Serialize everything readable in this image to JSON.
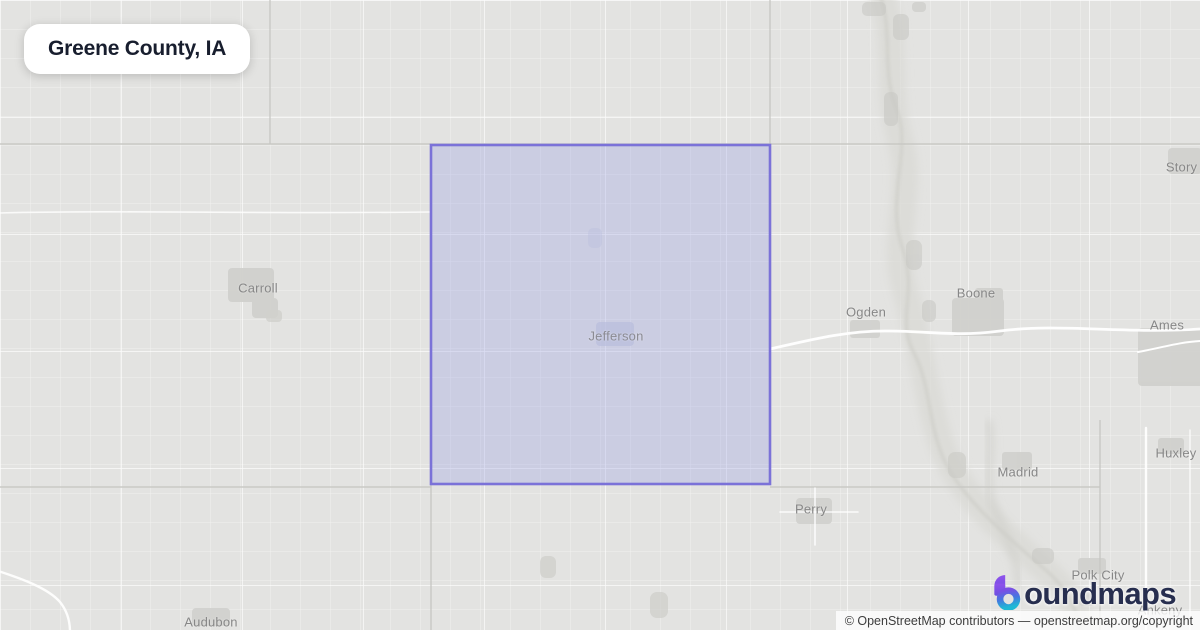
{
  "title_card": {
    "title": "Greene County, IA"
  },
  "map": {
    "county": {
      "name": "Greene",
      "fill_color": "#9ba1e4",
      "stroke_color": "#7b72d8"
    },
    "cities": [
      {
        "name": "Carroll"
      },
      {
        "name": "Jefferson"
      },
      {
        "name": "Ogden"
      },
      {
        "name": "Boone"
      },
      {
        "name": "Ames"
      },
      {
        "name": "Story City"
      },
      {
        "name": "Madrid"
      },
      {
        "name": "Huxley"
      },
      {
        "name": "Perry"
      },
      {
        "name": "Polk City"
      },
      {
        "name": "Ankeny"
      },
      {
        "name": "Audubon"
      }
    ],
    "base_colors": {
      "land": "#e3e3e1",
      "roads": "#ffffff",
      "water": "#cdcdc8",
      "label_text": "#878787"
    }
  },
  "logo": {
    "brand": "boundmaps",
    "wordmark_text": "oundmaps",
    "icon_colors": {
      "purple": "#8247e5",
      "blue": "#4577e0",
      "cyan": "#1fb8d5"
    },
    "text_color": "#272e4f"
  },
  "attribution": {
    "text": "© OpenStreetMap contributors",
    "separator": " — ",
    "link": "openstreetmap.org/copyright"
  }
}
